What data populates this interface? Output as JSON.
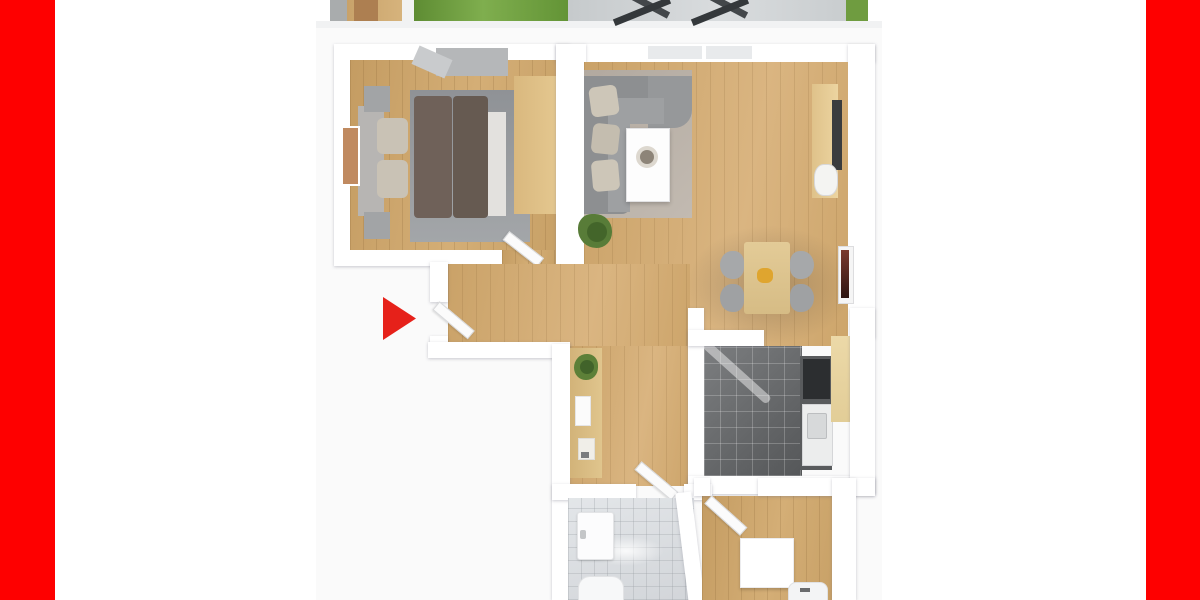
{
  "meta": {
    "title": "3D apartment floor plan rendering, cropped top and bottom, framed by red side bars",
    "canvas_width": 1200,
    "canvas_height": 600
  },
  "palette": {
    "frame_red": "#fe0000",
    "arrow_red": "#e6211a",
    "wall_white": "#ffffff",
    "wood_floor": "#cda76c",
    "kitchen_tile": "#717375",
    "bathroom_tile": "#dcdfe2",
    "grass_green": "#6f9c40",
    "sofa_gray": "#8d8f91",
    "bed_brown": "#6f6159",
    "rug_gray": "#93969a",
    "plan_backdrop": "#fafafa"
  },
  "scene": {
    "elements": [
      {
        "n": "plan-backdrop",
        "x": 316,
        "y": 22,
        "w": 566,
        "h": 578,
        "bg": "#fafafa"
      },
      {
        "n": "strip-underedge",
        "x": 316,
        "y": 21,
        "w": 566,
        "h": 7,
        "bg": "#f1f2f3"
      },
      {
        "n": "terrace-wall-strip",
        "x": 330,
        "y": 0,
        "w": 17,
        "h": 21,
        "bg": "#a9acad"
      },
      {
        "n": "terrace-wood-floor",
        "x": 347,
        "y": 0,
        "w": 55,
        "h": 21,
        "bg": "linear-gradient(90deg,#c8a26a,#d6b37c)"
      },
      {
        "n": "terrace-door",
        "x": 354,
        "y": 0,
        "w": 24,
        "h": 21,
        "bg": "#ad7f51"
      },
      {
        "n": "terrace-wall-edge",
        "x": 402,
        "y": 0,
        "w": 12,
        "h": 21,
        "bg": "#f1f2f2"
      },
      {
        "n": "garden-grass-left",
        "x": 414,
        "y": 0,
        "w": 154,
        "h": 21,
        "bg": "linear-gradient(90deg,#5e8c33,#7fae4e 45%,#639436)"
      },
      {
        "n": "balcony-tiles",
        "x": 568,
        "y": 0,
        "w": 278,
        "h": 21,
        "bg": "linear-gradient(90deg,#c6cacc,#d9dcde 55%,#c9cdcf)"
      },
      {
        "n": "lounge-chair-bar-1",
        "x": 612,
        "y": -2,
        "w": 60,
        "h": 7,
        "rot": 28,
        "bg": "#43474a"
      },
      {
        "n": "lounge-chair-bar-2",
        "x": 612,
        "y": 8,
        "w": 60,
        "h": 7,
        "rot": -22,
        "bg": "#34383b"
      },
      {
        "n": "lounge-chair-bar-3",
        "x": 690,
        "y": -2,
        "w": 60,
        "h": 7,
        "rot": 28,
        "bg": "#43474a"
      },
      {
        "n": "lounge-chair-bar-4",
        "x": 690,
        "y": 8,
        "w": 60,
        "h": 7,
        "rot": -22,
        "bg": "#34383b"
      },
      {
        "n": "garden-grass-right",
        "x": 846,
        "y": 0,
        "w": 22,
        "h": 21,
        "bg": "#6f9c40"
      },
      {
        "n": "bedroom-walls",
        "cls": "wall",
        "x": 334,
        "y": 44,
        "w": 236,
        "h": 222
      },
      {
        "n": "bedroom-floor",
        "cls": "wood",
        "x": 350,
        "y": 60,
        "w": 206,
        "h": 190
      },
      {
        "n": "bedroom-door-opening",
        "cls": "wood",
        "x": 502,
        "y": 250,
        "w": 54,
        "h": 16
      },
      {
        "n": "bedroom-rug",
        "x": 410,
        "y": 90,
        "w": 120,
        "h": 152,
        "bg": "linear-gradient(180deg,#8f9296,#a3a6a9)"
      },
      {
        "n": "bed-duvet-left",
        "x": 414,
        "y": 96,
        "w": 38,
        "h": 122,
        "bg": "#6f6159",
        "rad": "4px"
      },
      {
        "n": "bed-duvet-right",
        "x": 453,
        "y": 96,
        "w": 35,
        "h": 122,
        "bg": "#665a51",
        "rad": "4px"
      },
      {
        "n": "bed-sheet-fold",
        "x": 488,
        "y": 112,
        "w": 18,
        "h": 104,
        "bg": "#e3e1de"
      },
      {
        "n": "bed-headboard",
        "x": 358,
        "y": 106,
        "w": 26,
        "h": 110,
        "bg": "#b7b5b3"
      },
      {
        "n": "bed-pillow-top",
        "x": 377,
        "y": 118,
        "w": 31,
        "h": 36,
        "bg": "#c9c2b5",
        "rad": "6px"
      },
      {
        "n": "bed-pillow-bottom",
        "x": 377,
        "y": 160,
        "w": 31,
        "h": 38,
        "bg": "#c9c2b5",
        "rad": "6px"
      },
      {
        "n": "nightstand-top",
        "x": 364,
        "y": 86,
        "w": 26,
        "h": 26,
        "bg": "#a2a4a6"
      },
      {
        "n": "nightstand-bottom",
        "x": 364,
        "y": 212,
        "w": 26,
        "h": 27,
        "bg": "#a2a4a6"
      },
      {
        "n": "bedroom-wall-art",
        "x": 341,
        "y": 126,
        "w": 15,
        "h": 56,
        "bg": "#c08a60",
        "border": "2px solid #ffffff"
      },
      {
        "n": "bedroom-wardrobe",
        "x": 436,
        "y": 48,
        "w": 72,
        "h": 28,
        "bg": "#b5b7b9"
      },
      {
        "n": "bedroom-wardrobe-door",
        "x": 414,
        "y": 52,
        "w": 36,
        "h": 20,
        "rot": 24,
        "bg": "#c9cbcd"
      },
      {
        "n": "bedroom-closet",
        "x": 514,
        "y": 76,
        "w": 42,
        "h": 138,
        "bg": "linear-gradient(90deg,#d9b87e,#e4c78f)"
      },
      {
        "n": "bedroom-door-leaf",
        "cls": "doorleaf",
        "x": 506,
        "y": 230,
        "w": 42,
        "h": 9,
        "rot": 38
      },
      {
        "n": "living-top-wall",
        "cls": "wall",
        "x": 556,
        "y": 44,
        "w": 319,
        "h": 18
      },
      {
        "n": "living-window-1",
        "x": 648,
        "y": 46,
        "w": 54,
        "h": 13,
        "bg": "#e8eaec"
      },
      {
        "n": "living-window-2",
        "x": 706,
        "y": 46,
        "w": 46,
        "h": 13,
        "bg": "#e8eaec"
      },
      {
        "n": "living-left-wall",
        "cls": "wall",
        "x": 556,
        "y": 44,
        "w": 30,
        "h": 222
      },
      {
        "n": "living-right-wall",
        "cls": "wall",
        "x": 848,
        "y": 44,
        "w": 27,
        "h": 294
      },
      {
        "n": "living-floor",
        "cls": "wood2",
        "x": 584,
        "y": 62,
        "w": 264,
        "h": 284
      },
      {
        "n": "hall-floor-upper",
        "cls": "wood2",
        "x": 448,
        "y": 264,
        "w": 242,
        "h": 82
      },
      {
        "n": "hall-floor-lower",
        "cls": "wood2",
        "x": 568,
        "y": 346,
        "w": 122,
        "h": 140
      },
      {
        "n": "dining-floor-shadow",
        "x": 686,
        "y": 225,
        "w": 168,
        "h": 120,
        "bg": "radial-gradient(ellipse at 50% 50%, rgba(70,60,50,0.30), rgba(70,60,50,0) 70%)"
      },
      {
        "n": "living-rug",
        "x": 584,
        "y": 70,
        "w": 108,
        "h": 148,
        "bg": "linear-gradient(135deg,#b2a99f,#c2bab1)"
      },
      {
        "n": "sofa-back-vertical",
        "x": 584,
        "y": 76,
        "w": 46,
        "h": 138,
        "bg": "#8d8f91",
        "rad": "0 0 8px 0"
      },
      {
        "n": "sofa-back-horizontal",
        "x": 584,
        "y": 76,
        "w": 94,
        "h": 46,
        "bg": "#8d8f91"
      },
      {
        "n": "sofa-chaise",
        "x": 648,
        "y": 76,
        "w": 44,
        "h": 52,
        "bg": "#96989a",
        "rad": "0 0 18px 0"
      },
      {
        "n": "sofa-seat-vertical",
        "x": 608,
        "y": 104,
        "w": 22,
        "h": 108,
        "bg": "#9ea0a2"
      },
      {
        "n": "sofa-seat-horizontal",
        "x": 612,
        "y": 98,
        "w": 52,
        "h": 26,
        "bg": "#9ea0a2"
      },
      {
        "n": "sofa-pillow-1",
        "x": 590,
        "y": 86,
        "w": 28,
        "h": 30,
        "bg": "#cdc6b8",
        "rad": "6px",
        "rot": -8
      },
      {
        "n": "sofa-pillow-2",
        "x": 592,
        "y": 124,
        "w": 27,
        "h": 30,
        "bg": "#c4bdaf",
        "rad": "6px",
        "rot": 6
      },
      {
        "n": "sofa-pillow-3",
        "x": 592,
        "y": 160,
        "w": 27,
        "h": 31,
        "bg": "#cdc6b8",
        "rad": "6px",
        "rot": -5
      },
      {
        "n": "coffee-table",
        "x": 626,
        "y": 128,
        "w": 42,
        "h": 72,
        "bg": "#fdfdfd",
        "border": "1px solid #e2e2e4",
        "shadow": "0 2px 4px rgba(0,0,0,0.2)"
      },
      {
        "n": "coffee-table-bowl",
        "x": 636,
        "y": 146,
        "w": 22,
        "h": 22,
        "bg": "#ddd8cf",
        "rad": "50%"
      },
      {
        "n": "coffee-table-bowl-inner",
        "x": 640,
        "y": 150,
        "w": 14,
        "h": 14,
        "bg": "#8d8478",
        "rad": "50%"
      },
      {
        "n": "living-plant",
        "x": 578,
        "y": 214,
        "w": 34,
        "h": 34,
        "bg": "#587c38",
        "rad": "45% 55% 50% 60%"
      },
      {
        "n": "living-plant-core",
        "x": 587,
        "y": 222,
        "w": 20,
        "h": 20,
        "bg": "#3f6128",
        "rad": "50%",
        "op": 0.85
      },
      {
        "n": "desk",
        "x": 812,
        "y": 84,
        "w": 26,
        "h": 114,
        "bg": "linear-gradient(90deg,#dfc28a,#ecd4a0)"
      },
      {
        "n": "desk-monitor",
        "x": 832,
        "y": 100,
        "w": 10,
        "h": 70,
        "bg": "#3a3c3e"
      },
      {
        "n": "desk-chair",
        "x": 814,
        "y": 164,
        "w": 22,
        "h": 30,
        "bg": "#f4f4f2",
        "rad": "40%",
        "border": "1px solid #d8d8da"
      },
      {
        "n": "living-wall-art-frame",
        "x": 838,
        "y": 246,
        "w": 14,
        "h": 56,
        "bg": "#f5f5f5",
        "border": "1px solid #dddddf"
      },
      {
        "n": "living-wall-art",
        "x": 841,
        "y": 250,
        "w": 8,
        "h": 48,
        "bg": "linear-gradient(180deg,#7a3a2e,#2e1512)"
      },
      {
        "n": "dining-table",
        "x": 744,
        "y": 242,
        "w": 46,
        "h": 72,
        "bg": "linear-gradient(180deg,#e3cb97,#d6bc85)",
        "rad": "3px"
      },
      {
        "n": "dining-chair-1",
        "x": 720,
        "y": 251,
        "w": 24,
        "h": 28,
        "bg": "#a6a8aa",
        "rad": "50% 40% 40% 50%"
      },
      {
        "n": "dining-chair-2",
        "x": 720,
        "y": 284,
        "w": 24,
        "h": 28,
        "bg": "#9fa1a3",
        "rad": "50% 40% 40% 50%"
      },
      {
        "n": "dining-chair-3",
        "x": 790,
        "y": 251,
        "w": 24,
        "h": 28,
        "bg": "#a6a8aa",
        "rad": "40% 50% 50% 40%"
      },
      {
        "n": "dining-chair-4",
        "x": 790,
        "y": 284,
        "w": 24,
        "h": 28,
        "bg": "#9fa1a3",
        "rad": "40% 50% 50% 40%"
      },
      {
        "n": "dining-centerpiece",
        "x": 757,
        "y": 268,
        "w": 16,
        "h": 15,
        "bg": "#dfa52f",
        "rad": "40%"
      },
      {
        "n": "kitchen-left-wall",
        "cls": "wall",
        "x": 688,
        "y": 308,
        "w": 16,
        "h": 186
      },
      {
        "n": "kitchen-floor",
        "cls": "tile-dark",
        "x": 704,
        "y": 346,
        "w": 98,
        "h": 130
      },
      {
        "n": "kitchen-light-streak",
        "x": 694,
        "y": 368,
        "w": 86,
        "h": 9,
        "rot": 42,
        "bg": "rgba(255,255,255,0.45)",
        "rad": "4px"
      },
      {
        "n": "kitchen-counter-run",
        "x": 800,
        "y": 356,
        "w": 32,
        "h": 114,
        "bg": "#595b5d"
      },
      {
        "n": "kitchen-stove",
        "x": 803,
        "y": 359,
        "w": 27,
        "h": 40,
        "bg": "#2c2e30"
      },
      {
        "n": "kitchen-sink-unit",
        "x": 802,
        "y": 404,
        "w": 29,
        "h": 60,
        "bg": "#eceded",
        "border": "1px solid #d5d6d8"
      },
      {
        "n": "kitchen-sink-basin",
        "x": 807,
        "y": 413,
        "w": 18,
        "h": 24,
        "bg": "#d7d9da",
        "border": "1px solid #bcbec0",
        "rad": "2px"
      },
      {
        "n": "kitchen-counter-wood",
        "x": 831,
        "y": 336,
        "w": 21,
        "h": 86,
        "bg": "linear-gradient(180deg,#ecd9a8,#e2cd97)"
      },
      {
        "n": "kitchen-top-wall",
        "cls": "wall",
        "x": 688,
        "y": 330,
        "w": 76,
        "h": 16
      },
      {
        "n": "kitchen-bottom-wall",
        "cls": "wall",
        "x": 688,
        "y": 476,
        "w": 187,
        "h": 18
      },
      {
        "n": "kitchen-right-wall",
        "cls": "wall",
        "x": 850,
        "y": 308,
        "w": 25,
        "h": 186
      },
      {
        "n": "hall-west-wall-upper",
        "cls": "wall",
        "x": 430,
        "y": 262,
        "w": 18,
        "h": 40
      },
      {
        "n": "hall-west-wall-stub",
        "cls": "wall",
        "x": 430,
        "y": 336,
        "w": 18,
        "h": 14
      },
      {
        "n": "entry-door-leaf",
        "cls": "doorleaf",
        "x": 436,
        "y": 300,
        "w": 44,
        "h": 9,
        "rot": 40
      },
      {
        "n": "hall-outer-wall-bottom-left",
        "cls": "wall",
        "x": 428,
        "y": 342,
        "w": 142,
        "h": 16
      },
      {
        "n": "bath-west-wall",
        "cls": "wall",
        "x": 552,
        "y": 344,
        "w": 18,
        "h": 256
      },
      {
        "n": "hall-console",
        "x": 570,
        "y": 348,
        "w": 32,
        "h": 130,
        "bg": "linear-gradient(90deg,#d2b379,#e0c58d)"
      },
      {
        "n": "console-plant",
        "x": 574,
        "y": 354,
        "w": 24,
        "h": 26,
        "bg": "#5d8038",
        "rad": "55% 45% 50% 50%"
      },
      {
        "n": "console-plant-core",
        "x": 580,
        "y": 360,
        "w": 14,
        "h": 14,
        "bg": "#41632a",
        "rad": "50%"
      },
      {
        "n": "console-papers",
        "x": 575,
        "y": 396,
        "w": 14,
        "h": 28,
        "bg": "#fbfbfb",
        "border": "1px solid #e5e5e7"
      },
      {
        "n": "console-item",
        "x": 578,
        "y": 438,
        "w": 15,
        "h": 20,
        "bg": "#f0eee8",
        "border": "1px solid #e0ded8"
      },
      {
        "n": "console-item-detail",
        "x": 581,
        "y": 452,
        "w": 8,
        "h": 6,
        "bg": "#7a7c7e"
      },
      {
        "n": "bath-top-wall-left",
        "cls": "wall",
        "x": 552,
        "y": 484,
        "w": 84,
        "h": 16
      },
      {
        "n": "bath-top-wall-right",
        "cls": "wall",
        "x": 684,
        "y": 484,
        "w": 28,
        "h": 16
      },
      {
        "n": "bath-door-leaf",
        "cls": "doorleaf",
        "x": 638,
        "y": 460,
        "w": 46,
        "h": 9,
        "rot": 40
      },
      {
        "n": "bath-floor",
        "cls": "tile-light",
        "x": 568,
        "y": 498,
        "w": 126,
        "h": 102
      },
      {
        "n": "bath-light-glow",
        "x": 588,
        "y": 536,
        "w": 76,
        "h": 30,
        "bg": "radial-gradient(ellipse, rgba(255,255,255,0.85), rgba(255,255,255,0) 70%)"
      },
      {
        "n": "bath-sink",
        "x": 577,
        "y": 512,
        "w": 35,
        "h": 46,
        "bg": "#fcfcfd",
        "border": "1px solid #e3e4e6",
        "rad": "3px",
        "shadow": "0 1px 2px rgba(0,0,0,0.15)"
      },
      {
        "n": "bath-sink-faucet",
        "x": 580,
        "y": 530,
        "w": 6,
        "h": 9,
        "bg": "#c4c6c8",
        "rad": "2px"
      },
      {
        "n": "bath-toilet",
        "x": 578,
        "y": 576,
        "w": 44,
        "h": 24,
        "bg": "#f7f8f9",
        "rad": "12px 12px 0 0",
        "border": "1px solid #e2e3e5"
      },
      {
        "n": "bath-diagonal-wall",
        "cls": "wall",
        "x": 682,
        "y": 492,
        "w": 16,
        "h": 112,
        "rot": -7
      },
      {
        "n": "smallroom-floor",
        "cls": "wood",
        "x": 702,
        "y": 496,
        "w": 132,
        "h": 104
      },
      {
        "n": "smallroom-top-wall-left",
        "cls": "wall",
        "x": 694,
        "y": 478,
        "w": 16,
        "h": 18
      },
      {
        "n": "smallroom-top-wall-right",
        "cls": "wall",
        "x": 758,
        "y": 478,
        "w": 117,
        "h": 18
      },
      {
        "n": "smallroom-door-leaf",
        "cls": "doorleaf",
        "x": 708,
        "y": 494,
        "w": 46,
        "h": 9,
        "rot": 42
      },
      {
        "n": "smallroom-counter",
        "x": 740,
        "y": 538,
        "w": 52,
        "h": 48,
        "bg": "#ffffff",
        "border": "1px solid #ececee",
        "shadow": "0 2px 3px rgba(0,0,0,0.18)"
      },
      {
        "n": "smallroom-appliance",
        "x": 788,
        "y": 582,
        "w": 38,
        "h": 18,
        "bg": "#f3f4f5",
        "rad": "8px 8px 0 0",
        "border": "1px solid #e0e1e3"
      },
      {
        "n": "smallroom-appliance-detail",
        "x": 800,
        "y": 588,
        "w": 10,
        "h": 4,
        "bg": "#6a6c6e"
      },
      {
        "n": "smallroom-east-wall",
        "cls": "wall",
        "x": 832,
        "y": 478,
        "w": 24,
        "h": 122
      },
      {
        "n": "entrance-arrow-marker",
        "x": 383,
        "y": 297,
        "w": 33,
        "h": 43,
        "bg": "#e6211a",
        "clip": "polygon(0 0, 100% 50%, 0 100%)"
      },
      {
        "n": "left-red-bar",
        "x": 0,
        "y": 0,
        "w": 55,
        "h": 600,
        "bg": "#fe0000"
      },
      {
        "n": "right-red-bar",
        "x": 1146,
        "y": 0,
        "w": 54,
        "h": 600,
        "bg": "#fe0000"
      }
    ]
  }
}
